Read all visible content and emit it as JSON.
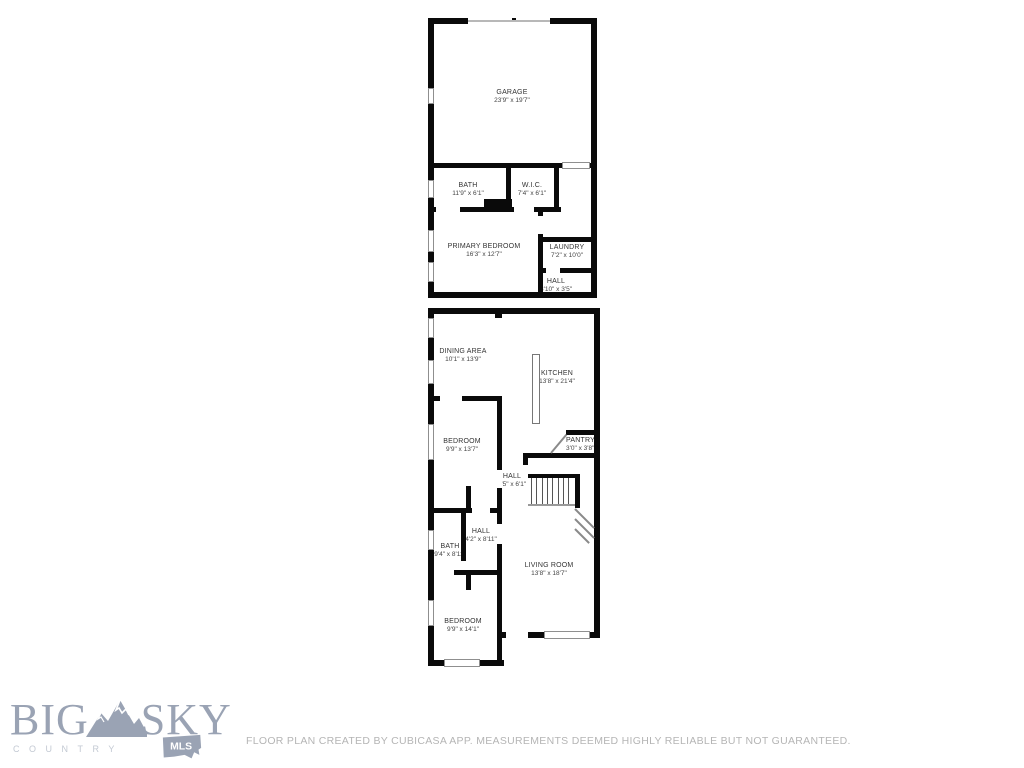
{
  "plan": {
    "wall_color": "#0a0a0a",
    "rooms": {
      "garage": {
        "name": "GARAGE",
        "dims": "23'9\" x 19'7\""
      },
      "bath_upper": {
        "name": "BATH",
        "dims": "11'9\" x 6'1\""
      },
      "wic": {
        "name": "W.I.C.",
        "dims": "7'4\" x 6'1\""
      },
      "primary_bedroom": {
        "name": "PRIMARY BEDROOM",
        "dims": "16'3\" x 12'7\""
      },
      "laundry": {
        "name": "LAUNDRY",
        "dims": "7'2\" x 10'0\""
      },
      "hall_upper": {
        "name": "HALL",
        "dims": "3'10\" x 3'5\""
      },
      "dining": {
        "name": "DINING AREA",
        "dims": "10'1\" x 13'9\""
      },
      "kitchen": {
        "name": "KITCHEN",
        "dims": "13'8\" x 21'4\""
      },
      "bedroom_mid": {
        "name": "BEDROOM",
        "dims": "9'9\" x 13'7\""
      },
      "pantry": {
        "name": "PANTRY",
        "dims": "3'0\" x 3'8\""
      },
      "hall_mid": {
        "name": "HALL",
        "dims": "9'5\" x 6'1\""
      },
      "hall_lower": {
        "name": "HALL",
        "dims": "4'2\" x 8'11\""
      },
      "bath_lower": {
        "name": "BATH",
        "dims": "9'4\" x 8'11\""
      },
      "living_room": {
        "name": "LIVING ROOM",
        "dims": "13'8\" x 18'7\""
      },
      "bedroom_bottom": {
        "name": "BEDROOM",
        "dims": "9'9\" x 14'1\""
      }
    }
  },
  "logo": {
    "word1": "BIG",
    "word2": "SKY",
    "tagline": "COUNTRY",
    "badge": "MLS",
    "color": "#9aa3b4"
  },
  "footer": {
    "disclaimer": "FLOOR PLAN CREATED BY CUBICASA APP. MEASUREMENTS DEEMED HIGHLY RELIABLE BUT NOT GUARANTEED."
  }
}
